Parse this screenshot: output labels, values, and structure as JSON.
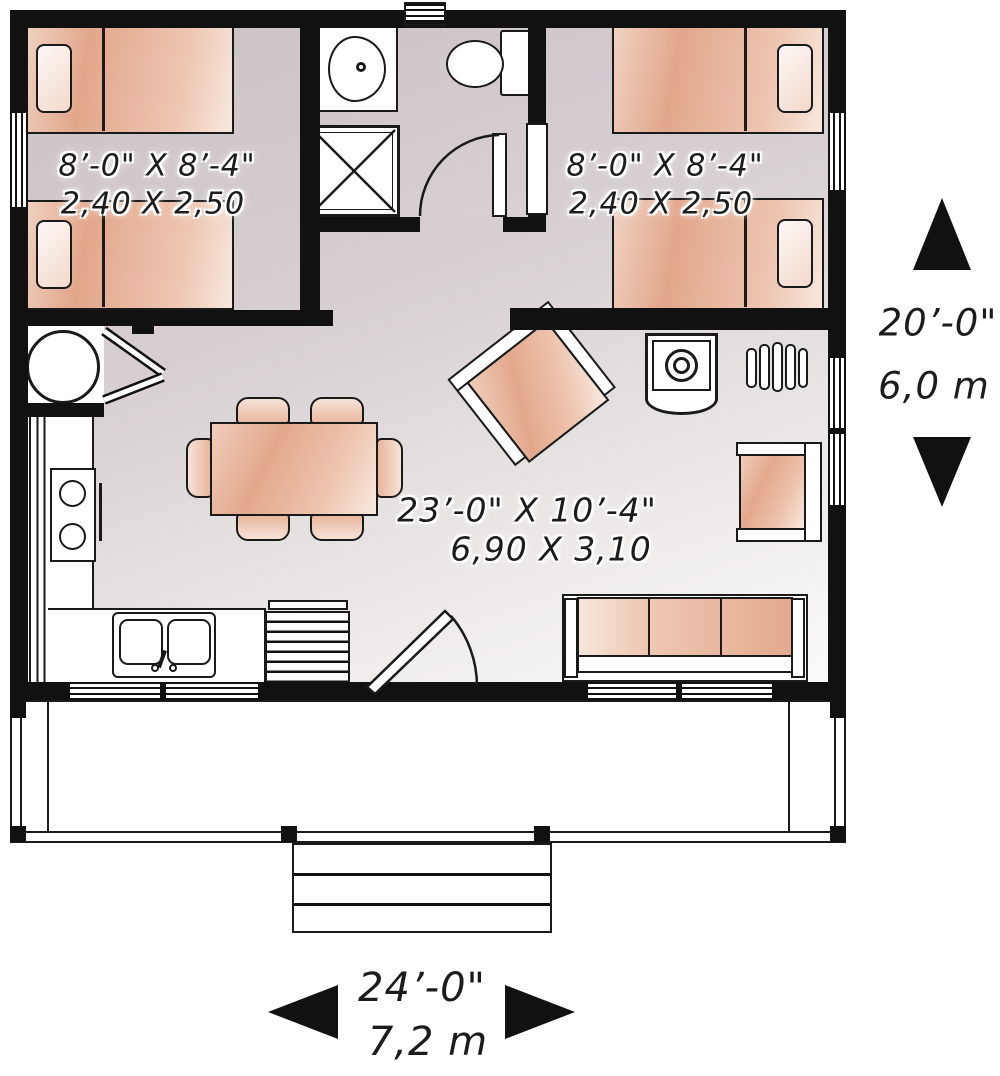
{
  "plan_labels": {
    "bedroom_left": {
      "imperial": "8’-0\" X 8’-4\"",
      "metric": "2,40 X 2,50"
    },
    "bedroom_right": {
      "imperial": "8’-0\" X 8’-4\"",
      "metric": "2,40 X 2,50"
    },
    "living_room": {
      "imperial": "23’-0\" X 10’-4\"",
      "metric": "6,90 X 3,10"
    },
    "overall_width": {
      "imperial": "24’-0\"",
      "metric": "7,2 m"
    },
    "overall_depth": {
      "imperial": "20’-0\"",
      "metric": "6,0 m"
    }
  },
  "colors": {
    "wall": "#111111",
    "line": "#1a1a1a",
    "peach": "#e2a98e",
    "peach_light": "#f7e6dc",
    "floor": "#d3cbce",
    "floor_light": "#f7f5f5"
  }
}
